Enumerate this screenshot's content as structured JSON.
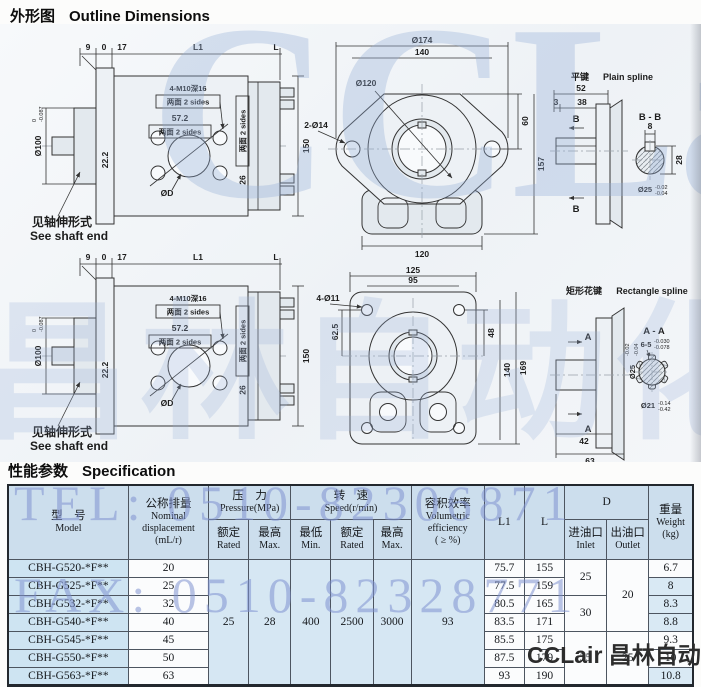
{
  "page": {
    "section1_zh": "外形图",
    "section1_en": "Outline Dimensions",
    "section2_zh": "性能参数",
    "section2_en": "Specification"
  },
  "watermark": {
    "tel": "TEL: 0510-82306871",
    "fax": "FAX: 0510-82328771",
    "brand_big": "CCLair",
    "brand_cn": "昌林自动化",
    "footer": "CCLair 昌林自动化",
    "accent_color": "#8292d0"
  },
  "drawings": {
    "side": {
      "dim9": "9",
      "dim0": "0",
      "dim17": "17",
      "dimL1": "L1",
      "dimL": "L",
      "dia100": "Ø100",
      "tol_top": "0",
      "tol_bot": "-0.087",
      "dim222": "22.2",
      "m10": "4-M10深16",
      "sides": "两面 2 sides",
      "dim572": "57.2",
      "dim26": "26",
      "dim150": "150",
      "diaD": "ØD",
      "note_zh": "见轴伸形式",
      "note_en": "See shaft end"
    },
    "round": {
      "dia174": "Ø174",
      "dim140": "140",
      "dia120": "Ø120",
      "holes": "2-Ø14",
      "dim60": "60",
      "dim157": "157",
      "dim120b": "120"
    },
    "rect": {
      "dim125": "125",
      "dim95": "95",
      "holes": "4-Ø11",
      "dim625": "62.5",
      "dim48": "48",
      "dim140": "140",
      "dim169": "169"
    },
    "pspline": {
      "t_zh": "平键",
      "t_en": "Plain spline",
      "sec": "B - B",
      "view": "B",
      "d52": "52",
      "d3": "3",
      "d38": "38",
      "d8": "8",
      "d28": "28",
      "dia25": "Ø25",
      "tt": "-0.02",
      "tb": "-0.04"
    },
    "rspline": {
      "t_zh": "矩形花键",
      "t_en": "Rectangle spline",
      "sec": "A - A",
      "view": "A",
      "d42": "42",
      "d63": "63",
      "s65": "6-5",
      "stt": "-0.030",
      "stb": "-0.078",
      "dia25": "Ø25",
      "p25t": "-0.02",
      "p25b": "-0.04",
      "dia21": "Ø21",
      "p21t": "-0.14",
      "p21b": "-0.42"
    }
  },
  "table": {
    "header": {
      "model_zh": "型　号",
      "model_en": "Model",
      "disp_zh": "公称排量",
      "disp_l1": "Nominal",
      "disp_l2": "displacement",
      "disp_l3": "(mL/r)",
      "press_zh": "压　力",
      "press_en": "Pressure(MPa)",
      "speed_zh": "转　速",
      "speed_en": "Speed(r/min)",
      "rated_zh": "额定",
      "rated_en": "Rated",
      "max_zh": "最高",
      "max_en": "Max.",
      "min_zh": "最低",
      "min_en": "Min.",
      "vol_zh": "容积效率",
      "vol_l1": "Volumetric",
      "vol_l2": "efficiency",
      "vol_l3": "( ≥ %)",
      "l1": "L1",
      "l": "L",
      "d": "D",
      "inlet_zh": "进油口",
      "inlet_en": "Inlet",
      "outlet_zh": "出油口",
      "outlet_en": "Outlet",
      "wt_zh": "重量",
      "wt_en": "Weight",
      "wt_u": "(kg)"
    },
    "merged": {
      "p_rated": "25",
      "p_max": "28",
      "s_min": "400",
      "s_rated": "2500",
      "s_max": "3000",
      "vol": "93"
    },
    "inlet": [
      "25",
      "30",
      "35"
    ],
    "outlet": [
      "20",
      "25"
    ],
    "rows": [
      {
        "model": "CBH-G520-*F**",
        "disp": "20",
        "l1": "75.7",
        "l": "155",
        "wt": "6.7"
      },
      {
        "model": "CBH-G525-*F**",
        "disp": "25",
        "l1": "77.5",
        "l": "159",
        "wt": "8"
      },
      {
        "model": "CBH-G532-*F**",
        "disp": "32",
        "l1": "80.5",
        "l": "165",
        "wt": "8.3"
      },
      {
        "model": "CBH-G540-*F**",
        "disp": "40",
        "l1": "83.5",
        "l": "171",
        "wt": "8.8"
      },
      {
        "model": "CBH-G545-*F**",
        "disp": "45",
        "l1": "85.5",
        "l": "175",
        "wt": "9.3"
      },
      {
        "model": "CBH-G550-*F**",
        "disp": "50",
        "l1": "87.5",
        "l": "179",
        "wt": "10"
      },
      {
        "model": "CBH-G563-*F**",
        "disp": "63",
        "l1": "93",
        "l": "190",
        "wt": "10.8"
      }
    ]
  }
}
